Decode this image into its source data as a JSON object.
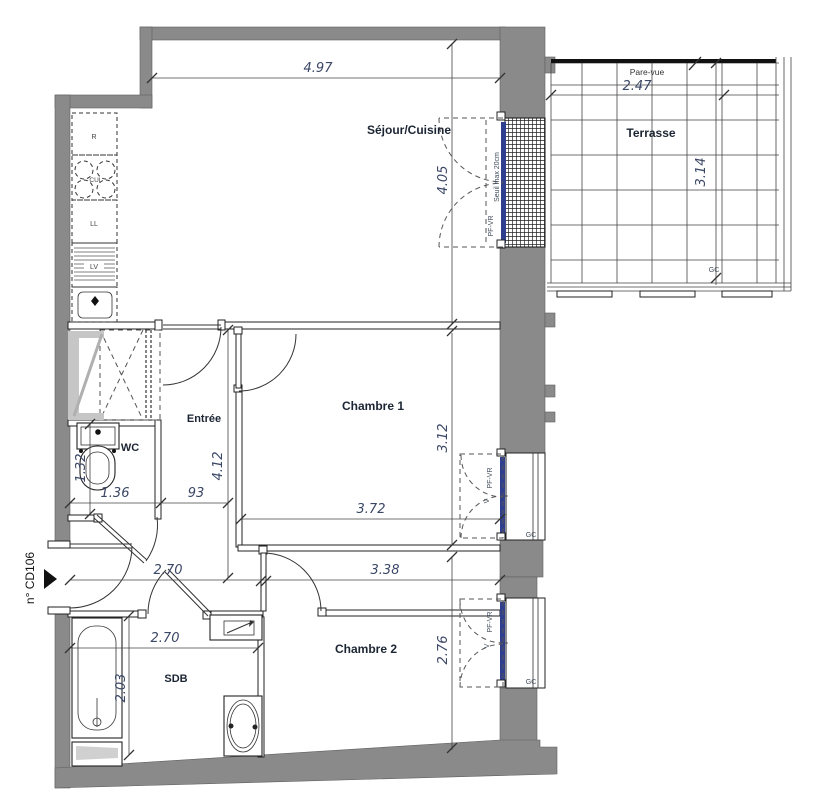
{
  "meta": {
    "reference": "n° CD106"
  },
  "rooms": {
    "sejour": "Séjour/Cuisine",
    "terrasse": "Terrasse",
    "entree": "Entrée",
    "chambre1": "Chambre 1",
    "wc": "WC",
    "sdb": "SDB",
    "chambre2": "Chambre 2"
  },
  "dims": {
    "sejour_w": "4.97",
    "sejour_h": "4.05",
    "terrasse_w": "2.47",
    "terrasse_h": "3.14",
    "chambre1_w": "3.72",
    "chambre1_h": "3.12",
    "chambre2_w": "3.38",
    "chambre2_h": "2.76",
    "entree_l": "4.12",
    "wc_w": "1.36",
    "wc_h": "1.32",
    "hall_w": "93",
    "hall_l": "2.70",
    "sdb_w": "2.70",
    "sdb_h": "2.03"
  },
  "annotations": {
    "pare_vue": "Pare-vue",
    "seuil": "Seuil max 20cm",
    "pf_vr": "PF-VR",
    "gc": "GC",
    "v": "V"
  },
  "appliances": {
    "fridge": "R",
    "hob": "CUI",
    "washer": "LL",
    "dishwasher": "LV"
  },
  "colors": {
    "wall": "#8a8a8a",
    "glazing": "#2e3f8f",
    "dim_text": "#3b4766",
    "label_text": "#1c2533"
  }
}
